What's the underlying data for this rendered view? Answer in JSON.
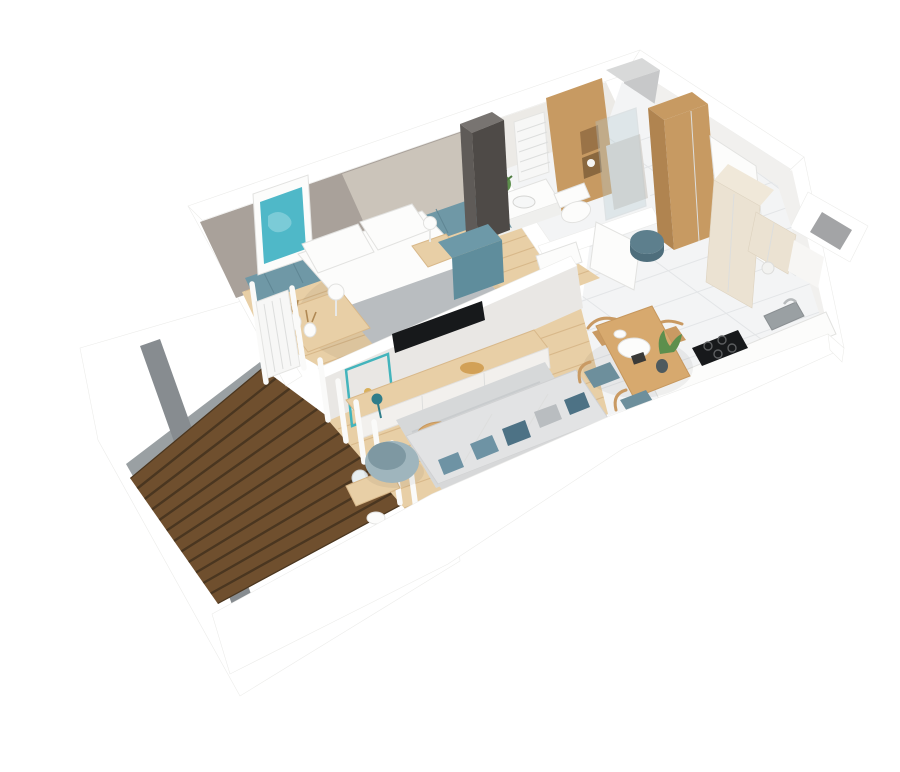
{
  "scene": {
    "title": "3D cutaway floor plan render of a one-bedroom apartment with balcony",
    "view": "isometric top-down 3D render",
    "rooms": [
      {
        "name": "Bedroom",
        "floor": "light oak planks",
        "furniture": [
          "double bed with white bedding and gray throw",
          "teal paneled wainscot",
          "teal abstract wall art",
          "dark wardrobe",
          "teal dresser",
          "bedside bench with vases",
          "white sphere lamps",
          "window radiator"
        ]
      },
      {
        "name": "Bathroom",
        "floor": "white tile",
        "furniture": [
          "towel radiator",
          "washbasin counter with plant",
          "toilet",
          "wood panel wall with niche",
          "glass shower",
          "white door"
        ]
      },
      {
        "name": "Hallway",
        "floor": "white tile",
        "furniture": [
          "tall oak wardrobe",
          "white entrance door",
          "teal pouf"
        ]
      },
      {
        "name": "Kitchen",
        "floor": "white tile",
        "furniture": [
          "cream tall cabinet",
          "cream upper cabinets",
          "white counter",
          "dark sink",
          "black induction cooktop",
          "vent shaft"
        ]
      },
      {
        "name": "Dining area",
        "floor": "white tile",
        "furniture": [
          "oak dining table",
          "two wooden chairs",
          "two teal-seat chairs",
          "serving platter",
          "potted plant"
        ]
      },
      {
        "name": "Living room",
        "floor": "light oak planks",
        "furniture": [
          "gray sofa with teal pillows",
          "round teal armchair",
          "two round oak coffee tables",
          "gray rug",
          "wall-mounted TV on partition",
          "sideboard with teal lamp",
          "balcony window with curtains"
        ]
      },
      {
        "name": "Balcony",
        "floor": "dark wood decking",
        "furniture": [
          "white parapet walls"
        ]
      }
    ]
  },
  "palette": {
    "page_bg": "#ffffff",
    "wall_white": "#ffffff",
    "wall_light": "#f1f0ee",
    "wall_taupe": "#a9a19a",
    "wall_panel": "#cbc4ba",
    "parapet_gray": "#878c90",
    "concrete": "#c7c8c9",
    "wainscot": "#6f98a6",
    "art_teal": "#4fb8c8",
    "wood": "#e8cfa6",
    "wood_line": "#d8b88a",
    "deck": "#6f4f2e",
    "deck_line": "#4a3620",
    "tile": "#f3f4f5",
    "tile_line": "#e3e5e7",
    "cab_wood": "#c79a62",
    "cab_wood_dark": "#b08450",
    "cream": "#ebe2d2",
    "dark_wardrobe": "#4e4a47",
    "teal_cabinet": "#5f8d9c",
    "pouf": "#5d7f8d",
    "sofa": "#e2e3e4",
    "sofa_back": "#d7d8d9",
    "pillow_teal": "#6e93a4",
    "pillow_slate": "#4d7285",
    "pillow_gray": "#b9bdc0",
    "armchair": "#9fb5bd",
    "armchair_dark": "#7e98a2",
    "table_wood": "#d7a96e",
    "chair_wood": "#c99a63",
    "seat_teal": "#6d8f9c",
    "rug": "#d6d8d9",
    "rug_line": "#c6c9ca",
    "tv": "#17191b",
    "fixture": "#fcfcfb",
    "fixture_edge": "#e2e2e0",
    "radiator": "#f7f7f6",
    "plant": "#5d8f4d",
    "red_accent": "#c44536",
    "glass": "#b8cdd3"
  }
}
